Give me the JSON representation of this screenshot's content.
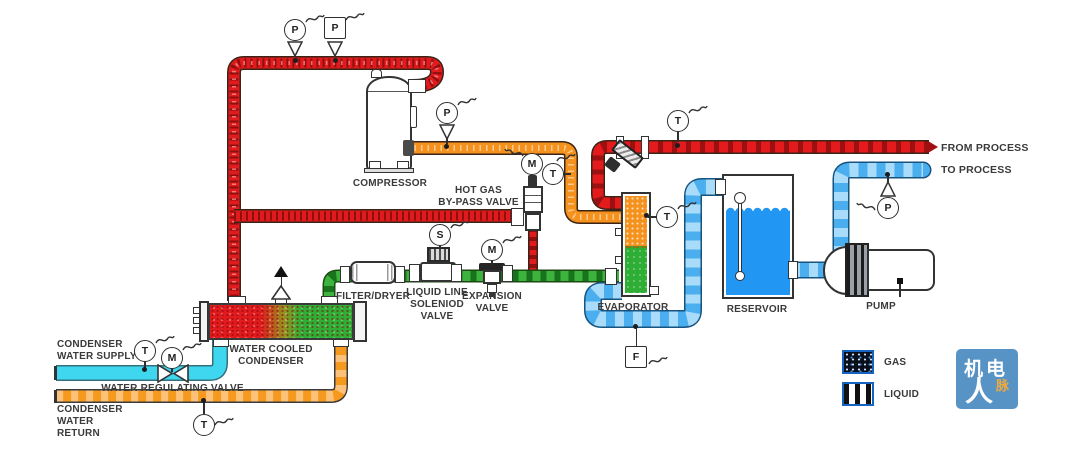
{
  "labels": {
    "compressor": "COMPRESSOR",
    "hot_gas_bypass_valve": "HOT GAS\nBY-PASS VALVE",
    "filter_dryer": "FILTER/DRYER",
    "liquid_line_solenoid_valve": "LIQUID LINE\nSOLENIOD\nVALVE",
    "expansion_valve": "EXPANSION\nVALVE",
    "evaporator": "EVAPORATOR",
    "reservoir": "RESERVOIR",
    "pump": "PUMP",
    "water_cooled_condenser": "WATER COOLED\nCONDENSER",
    "condenser_water_supply": "CONDENSER\nWATER SUPPLY",
    "water_regulating_valve": "WATER REGULATING VALVE",
    "condenser_water_return": "CONDENSER\nWATER RETURN",
    "from_process": "FROM PROCESS",
    "to_process": "TO PROCESS"
  },
  "legend": {
    "gas": "GAS",
    "liquid": "LIQUID"
  },
  "instruments": {
    "p_discharge_a": "P",
    "p_discharge_b": "P",
    "p_suction": "P",
    "m_bypass": "M",
    "t_suction": "T",
    "s_solenoid": "S",
    "m_expansion": "M",
    "t_from_process": "T",
    "t_evaporator": "T",
    "f_flow": "F",
    "p_to_process": "P",
    "t_supply": "T",
    "m_regulating": "M",
    "t_return": "T"
  },
  "logo": {
    "text_top": "机电",
    "text_main": "人",
    "text_accent": "脉"
  },
  "colors": {
    "hot_gas_red": "#e11b1d",
    "suction_orange": "#f5921e",
    "liquid_green": "#2fae35",
    "chilled_water_blue": "#4aaeef",
    "condenser_supply_cyan": "#3ed7ef",
    "condenser_return_orange": "#f59a1f",
    "reservoir_water_blue": "#2196f3",
    "legend_border_blue": "#1565c0",
    "logo_blue": "#5794c5"
  }
}
